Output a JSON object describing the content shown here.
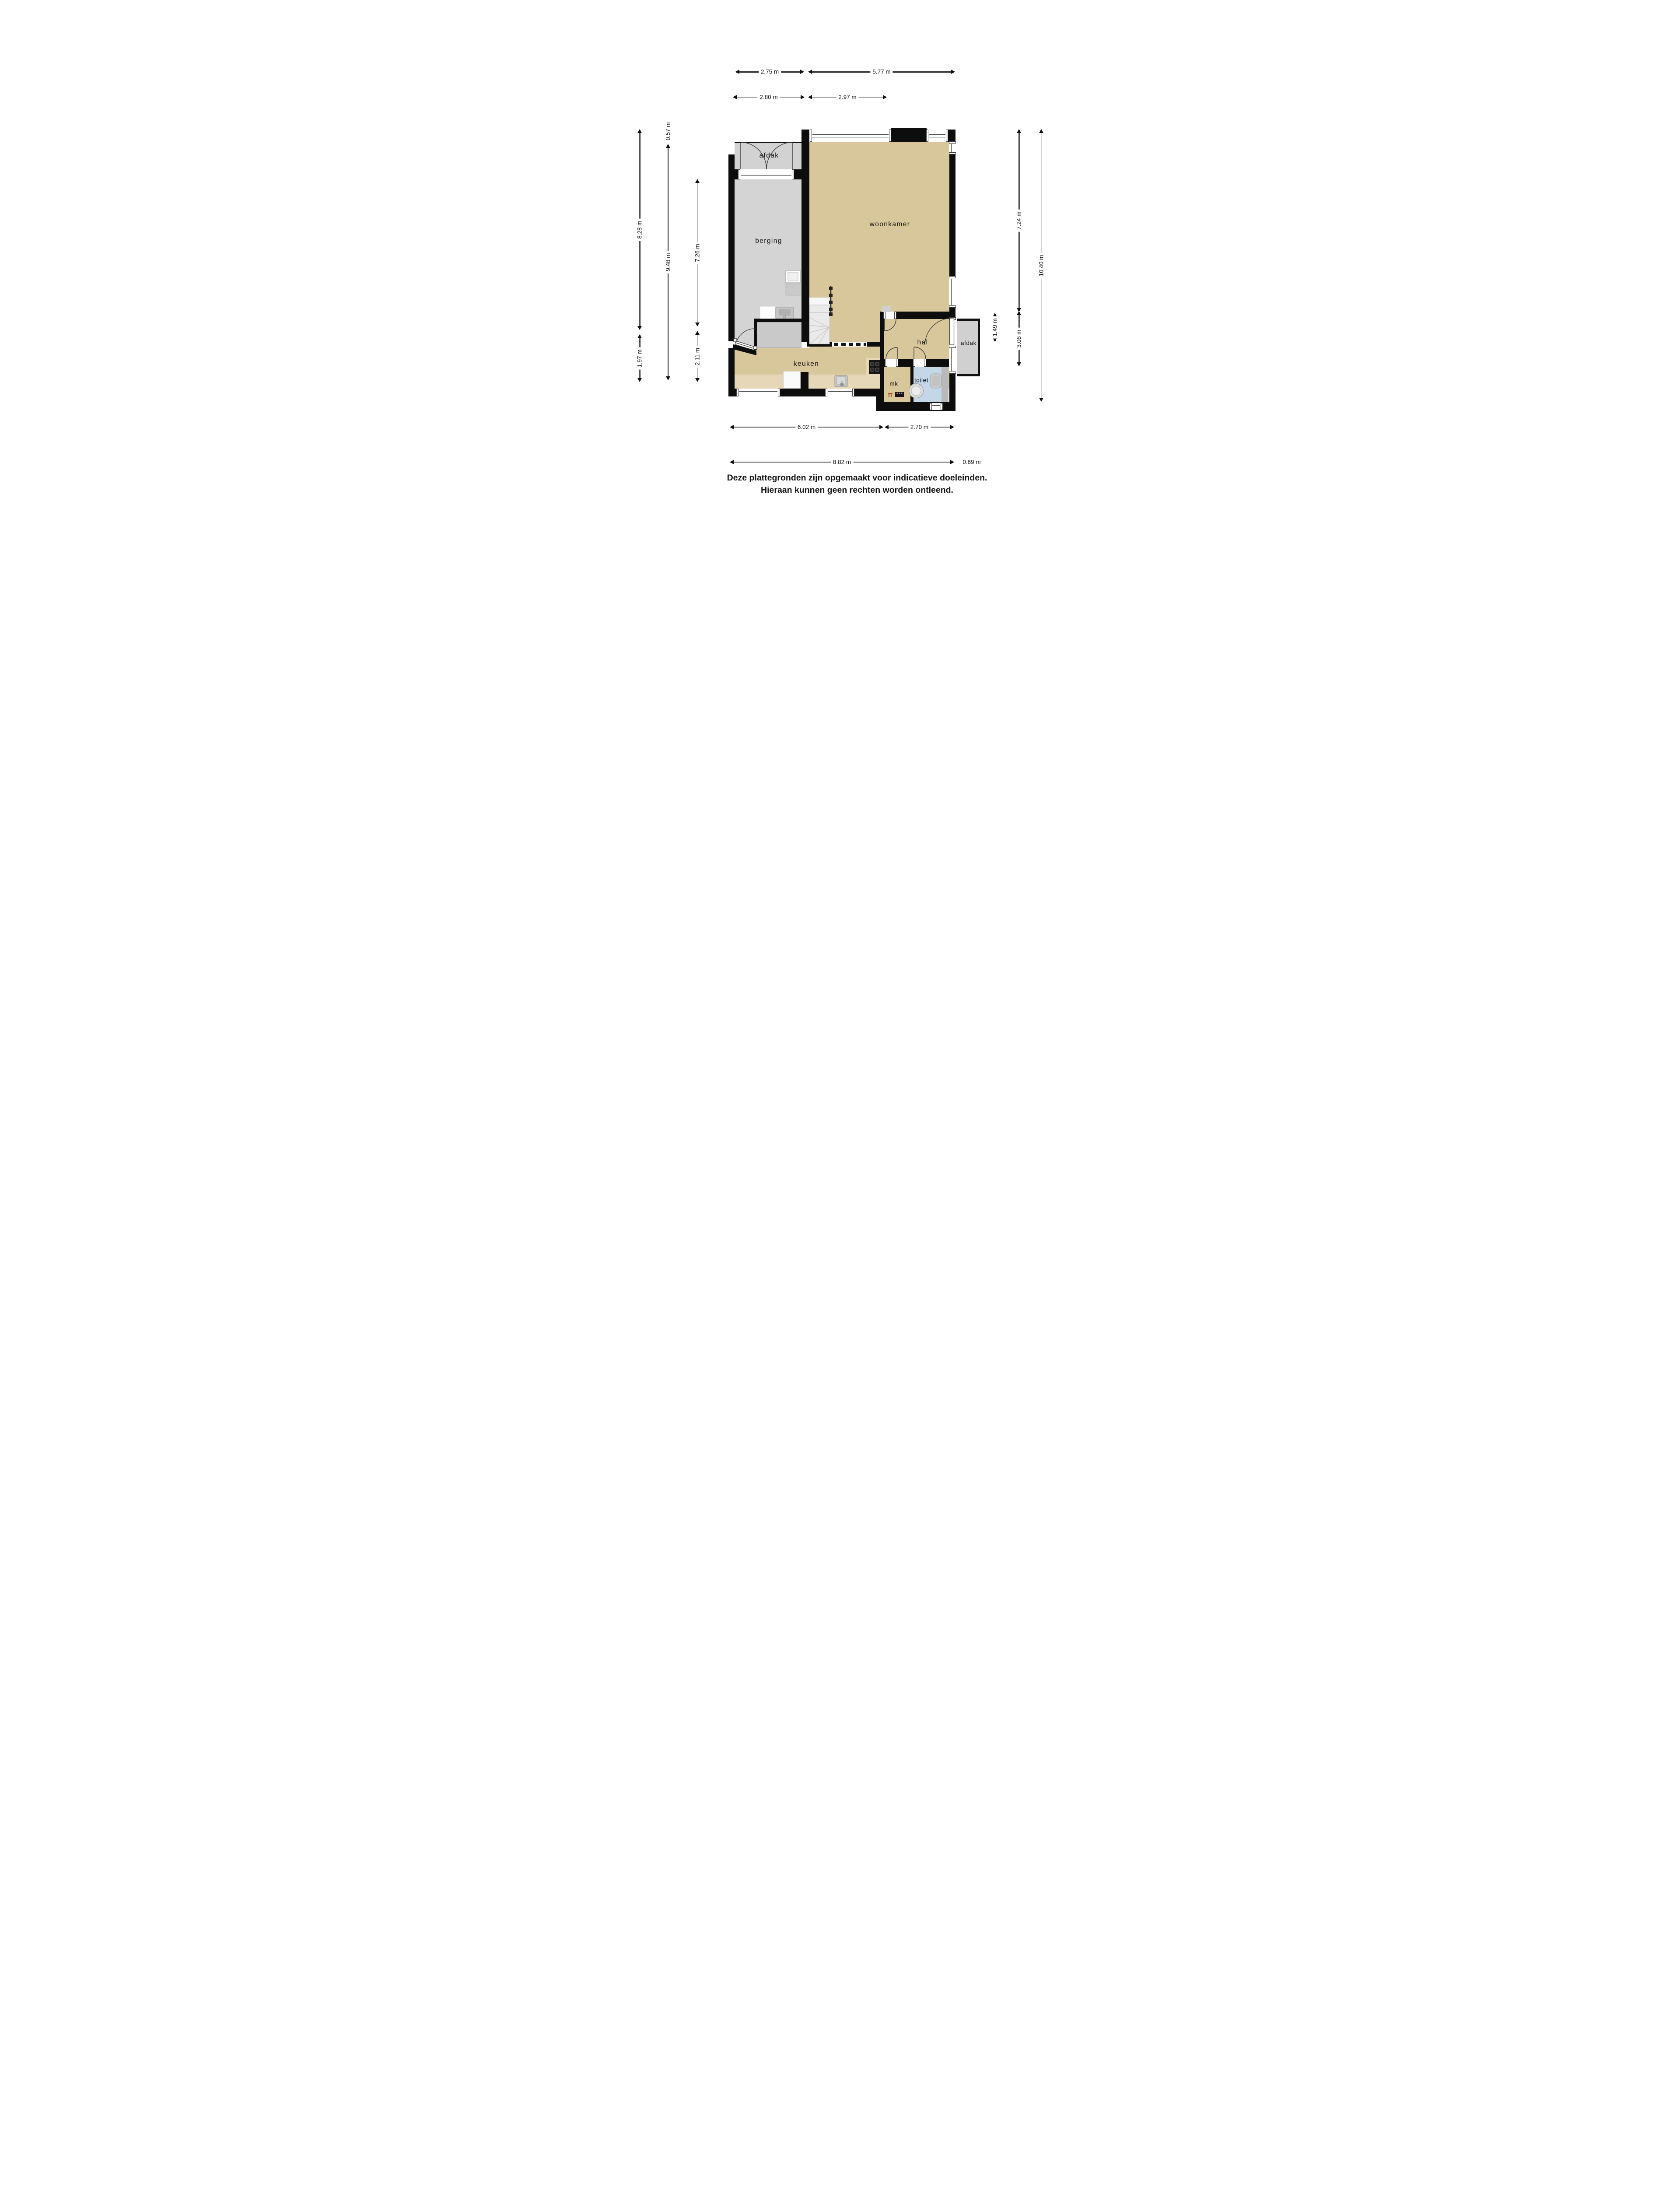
{
  "rooms": {
    "afdak_top": "afdak",
    "berging": "berging",
    "woonkamer": "woonkamer",
    "keuken": "keuken",
    "hal": "hal",
    "afdak_right": "afdak",
    "mk": "mk",
    "toilet": "toilet"
  },
  "dims": {
    "top1a": "2.75 m",
    "top1b": "5.77 m",
    "top2a": "2.80 m",
    "top2b": "2.97 m",
    "left_outer": "8.28 m",
    "left_outer2": "1.97 m",
    "left_mid_small": "0.57 m",
    "left_mid": "9.48 m",
    "left_inner": "7.26 m",
    "left_inner2": "2.11 m",
    "right_inner": "7.24 m",
    "right_afdak": "1.49 m",
    "right_inner2": "3.06 m",
    "right_outer": "10.40 m",
    "bottom1a": "6.02 m",
    "bottom1b": "2.70 m",
    "bottom2a": "8.82 m",
    "bottom2b": "0.69 m"
  },
  "disclaimer": {
    "line1": "Deze plattegronden zijn opgemaakt voor indicatieve doeleinden.",
    "line2": "Hieraan kunnen geen rechten worden ontleend."
  }
}
